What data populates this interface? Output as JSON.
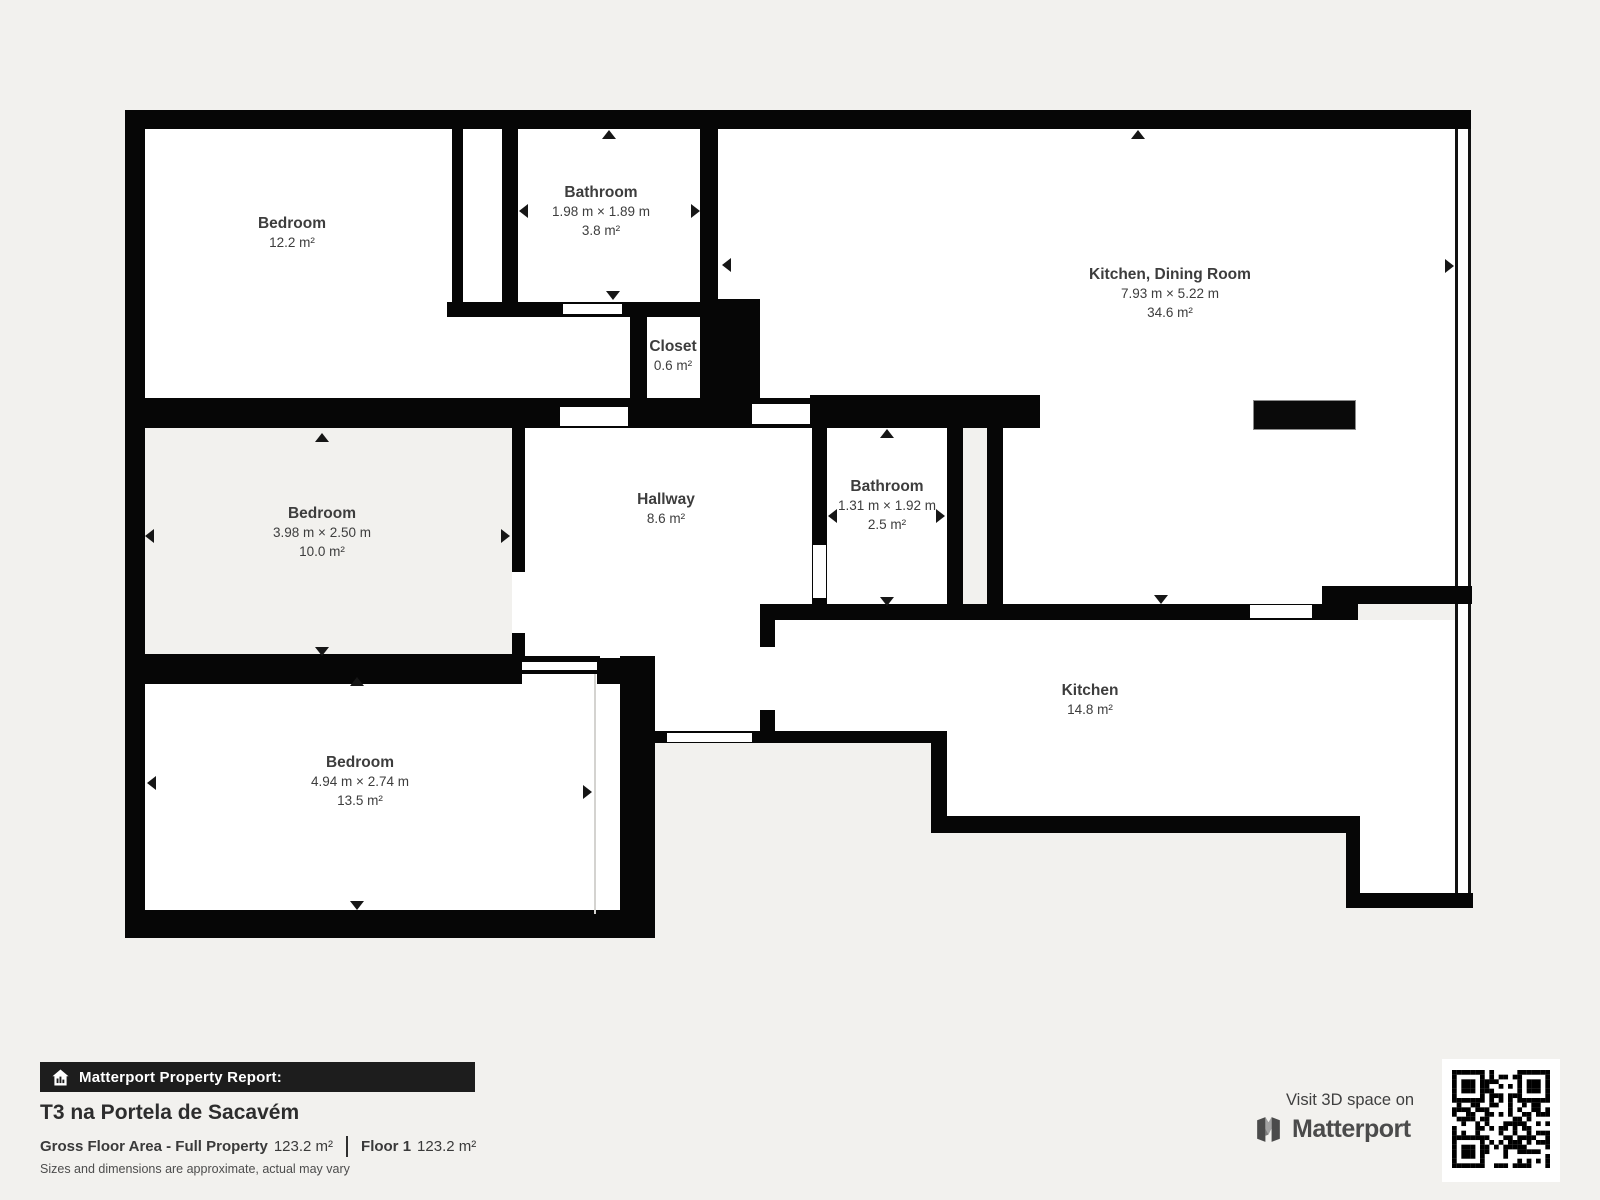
{
  "colors": {
    "background": "#f2f1ee",
    "wall": "#060606",
    "room_fill": "#ffffff",
    "label_text": "#3d3d3d",
    "banner_bg": "#1d1d1d"
  },
  "rooms": {
    "bedroom_top": {
      "name": "Bedroom",
      "area": "12.2 m²"
    },
    "bathroom_top": {
      "name": "Bathroom",
      "dims": "1.98 m × 1.89 m",
      "area": "3.8 m²"
    },
    "closet": {
      "name": "Closet",
      "area": "0.6 m²"
    },
    "kitchen_dining": {
      "name": "Kitchen, Dining Room",
      "dims": "7.93 m × 5.22 m",
      "area": "34.6 m²"
    },
    "bedroom_mid": {
      "name": "Bedroom",
      "dims": "3.98 m × 2.50 m",
      "area": "10.0 m²"
    },
    "hallway": {
      "name": "Hallway",
      "area": "8.6 m²"
    },
    "bathroom_mid": {
      "name": "Bathroom",
      "dims": "1.31 m × 1.92 m",
      "area": "2.5 m²"
    },
    "kitchen": {
      "name": "Kitchen",
      "area": "14.8 m²"
    },
    "bedroom_bottom": {
      "name": "Bedroom",
      "dims": "4.94 m × 2.74 m",
      "area": "13.5 m²"
    }
  },
  "footer": {
    "report_label": "Matterport Property Report:",
    "property_title": "T3 na Portela de Sacavém",
    "gfa_label": "Gross Floor Area - Full Property",
    "gfa_value": "123.2 m²",
    "floor_label": "Floor 1",
    "floor_value": "123.2 m²",
    "disclaimer": "Sizes and dimensions are approximate, actual may vary"
  },
  "visit": {
    "label": "Visit 3D space on",
    "brand": "Matterport",
    "icons": [
      "house-chart-icon",
      "matterport-logo-icon",
      "qr-code"
    ]
  }
}
